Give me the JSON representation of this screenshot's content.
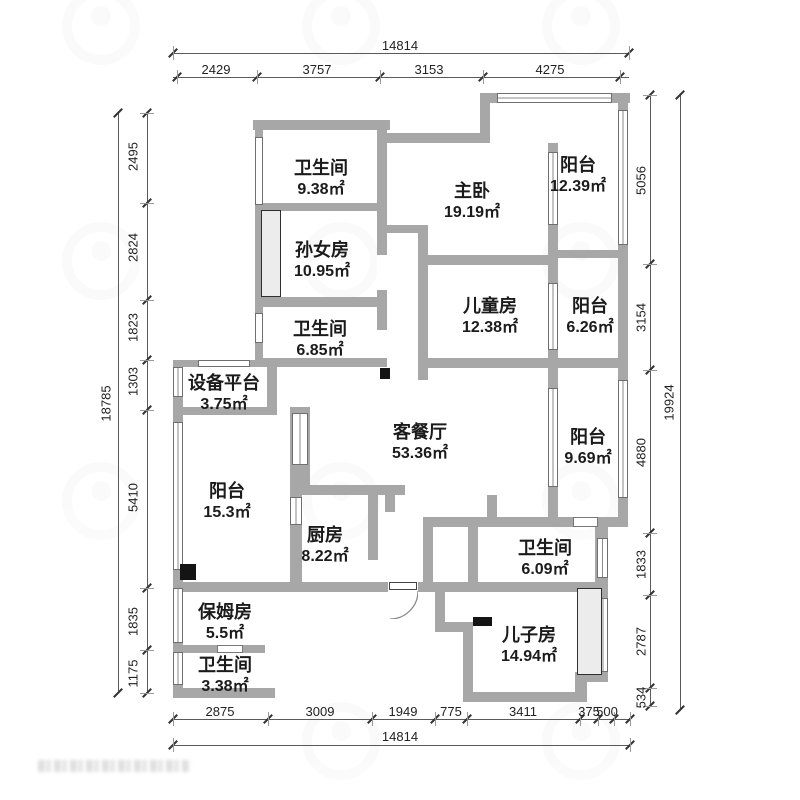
{
  "rooms": [
    {
      "name": "卫生间",
      "area": "9.38㎡"
    },
    {
      "name": "孙女房",
      "area": "10.95㎡"
    },
    {
      "name": "卫生间",
      "area": "6.85㎡"
    },
    {
      "name": "设备平台",
      "area": "3.75㎡"
    },
    {
      "name": "阳台",
      "area": "15.3㎡"
    },
    {
      "name": "保姆房",
      "area": "5.5㎡"
    },
    {
      "name": "卫生间",
      "area": "3.38㎡"
    },
    {
      "name": "厨房",
      "area": "8.22㎡"
    },
    {
      "name": "客餐厅",
      "area": "53.36㎡"
    },
    {
      "name": "主卧",
      "area": "19.19㎡"
    },
    {
      "name": "阳台",
      "area": "12.39㎡"
    },
    {
      "name": "儿童房",
      "area": "12.38㎡"
    },
    {
      "name": "阳台",
      "area": "6.26㎡"
    },
    {
      "name": "阳台",
      "area": "9.69㎡"
    },
    {
      "name": "卫生间",
      "area": "6.09㎡"
    },
    {
      "name": "儿子房",
      "area": "14.94㎡"
    }
  ],
  "dimensions": {
    "top": {
      "total": "14814",
      "segments": [
        "2429",
        "3757",
        "3153",
        "4275"
      ]
    },
    "bottom": {
      "total": "14814",
      "segments": [
        "2875",
        "3009",
        "1949",
        "775",
        "3411",
        "375",
        "500"
      ]
    },
    "left": {
      "total": "18785",
      "segments": [
        "2495",
        "2824",
        "1823",
        "1303",
        "5410",
        "1835",
        "1175"
      ]
    },
    "right": {
      "total": "19924",
      "segments": [
        "5056",
        "3154",
        "4880",
        "1833",
        "2787",
        "534"
      ]
    }
  },
  "colors": {
    "wall": "#a7a7a7",
    "line": "#5a5a5a",
    "text": "#1b1b1b"
  }
}
